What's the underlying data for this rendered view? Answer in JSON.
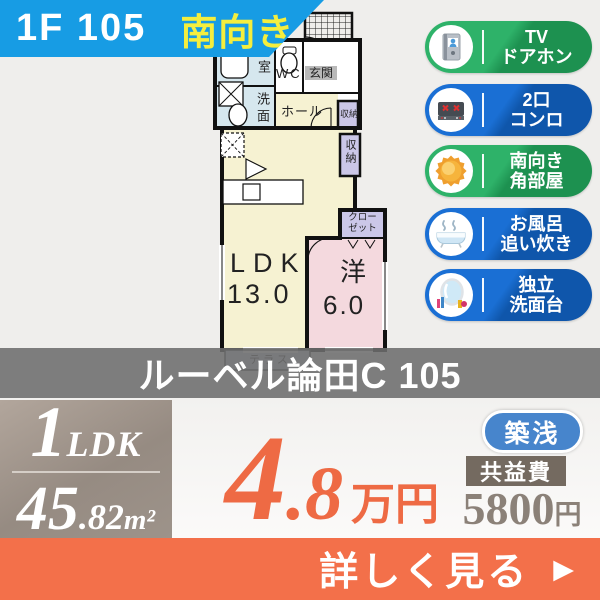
{
  "banner": {
    "floor_unit": "1F 105",
    "direction": "南向き"
  },
  "floorplan": {
    "bath": "浴室",
    "washroom": "洗面",
    "wc": "WC",
    "entrance": "玄関",
    "hall": "ホール",
    "storage_upper": "収納",
    "storage_lower": "収納",
    "closet_line1": "クロー",
    "closet_line2": "ゼット",
    "ldk_name": "LDK",
    "ldk_size": "13.0",
    "western_name": "洋",
    "western_size": "6.0",
    "terrace": "テラス"
  },
  "features": [
    {
      "line1": "TV",
      "line2": "ドアホン",
      "variant": "green",
      "icon": "tv-doorphone"
    },
    {
      "line1": "2口",
      "line2": "コンロ",
      "variant": "blue",
      "icon": "gas-stove"
    },
    {
      "line1": "南向き",
      "line2": "角部屋",
      "variant": "green",
      "icon": "sun"
    },
    {
      "line1": "お風呂",
      "line2": "追い炊き",
      "variant": "blue",
      "icon": "bathtub"
    },
    {
      "line1": "独立",
      "line2": "洗面台",
      "variant": "blue",
      "icon": "washstand"
    }
  ],
  "property": {
    "name": "ルーベル論田C 105"
  },
  "specs": {
    "layout_num": "1",
    "layout_type": "LDK",
    "area_int": "45",
    "area_dec": ".82",
    "area_unit": "m²"
  },
  "price": {
    "amount_int": "4",
    "amount_dec": ".8",
    "unit": "万円"
  },
  "badges": {
    "age": "築浅"
  },
  "fees": {
    "label": "共益費",
    "amount": "5800",
    "unit": "円"
  },
  "cta": {
    "label": "詳しく見る",
    "arrow": "▶"
  },
  "colors": {
    "banner_bg": "#179ce4",
    "banner_text": "#ffffff",
    "direction_text": "#f4ee3e",
    "badge_green_light": "#2eb269",
    "badge_green_dark": "#1d9150",
    "badge_blue_light": "#1a6fd4",
    "badge_blue_dark": "#0f56ab",
    "name_band_bg": "#6d6d6d",
    "spec_box_bg": "#9a8f85",
    "price_orange": "#ee6a44",
    "age_pill_bg": "#4785cc",
    "fee_label_bg": "#746a60",
    "fee_text": "#8b8178",
    "cta_bg": "#f3704a",
    "room_cream": "#f6f2d2",
    "room_pink": "#f4d9de",
    "room_blue": "#d6e7ee",
    "room_purple": "#cbc7e8",
    "terrace_blue": "#ccd5e5"
  }
}
